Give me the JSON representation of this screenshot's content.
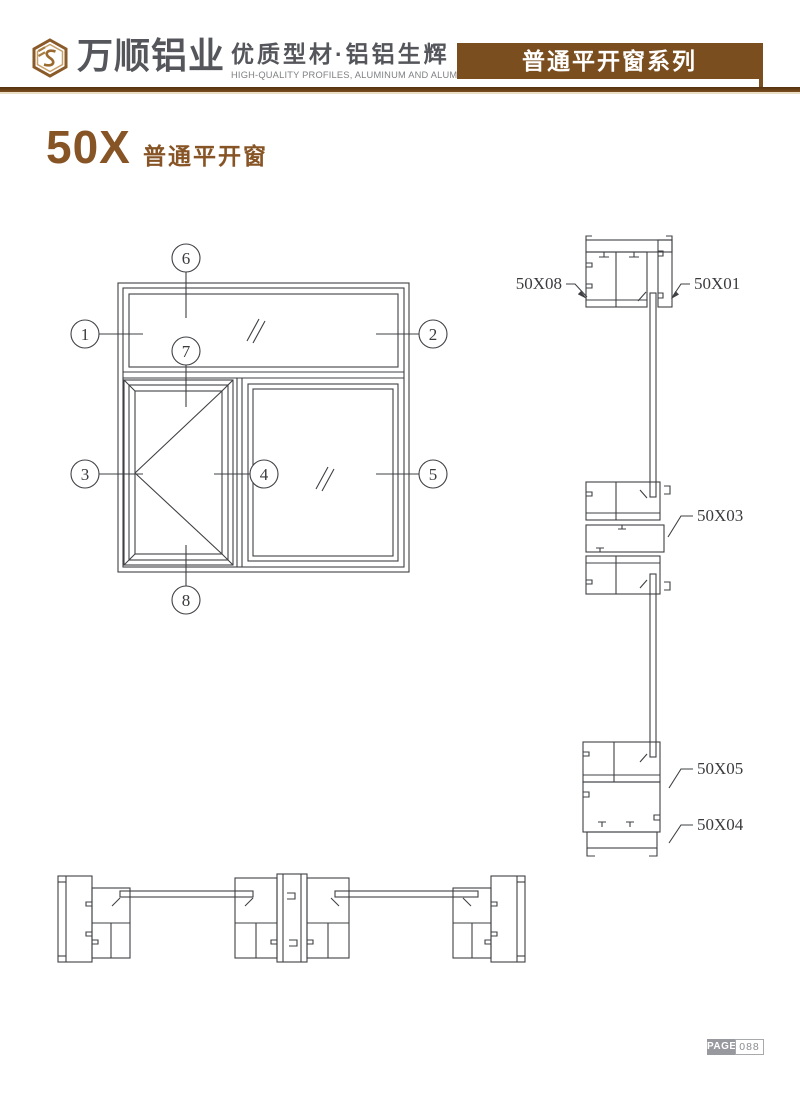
{
  "header": {
    "company_name": "万顺铝业",
    "tagline": "优质型材·铝铝生辉",
    "tagline_en": "HIGH-QUALITY PROFILES, ALUMINUM AND ALUMINUM",
    "series_banner": "普通平开窗系列"
  },
  "page_title": {
    "model": "50X",
    "name": "普通平开窗"
  },
  "elevation": {
    "callouts": [
      "1",
      "2",
      "3",
      "4",
      "5",
      "6",
      "7",
      "8"
    ]
  },
  "profiles": {
    "labels": [
      "50X08",
      "50X01",
      "50X03",
      "50X05",
      "50X04"
    ]
  },
  "footer": {
    "page_label": "PAGE",
    "page_number": "088"
  },
  "colors": {
    "brand_brown": "#7a4e1f",
    "title_brown": "#875426",
    "line_color": "#3f4044",
    "text_gray": "#54565b",
    "badge_gray": "#97999e"
  }
}
